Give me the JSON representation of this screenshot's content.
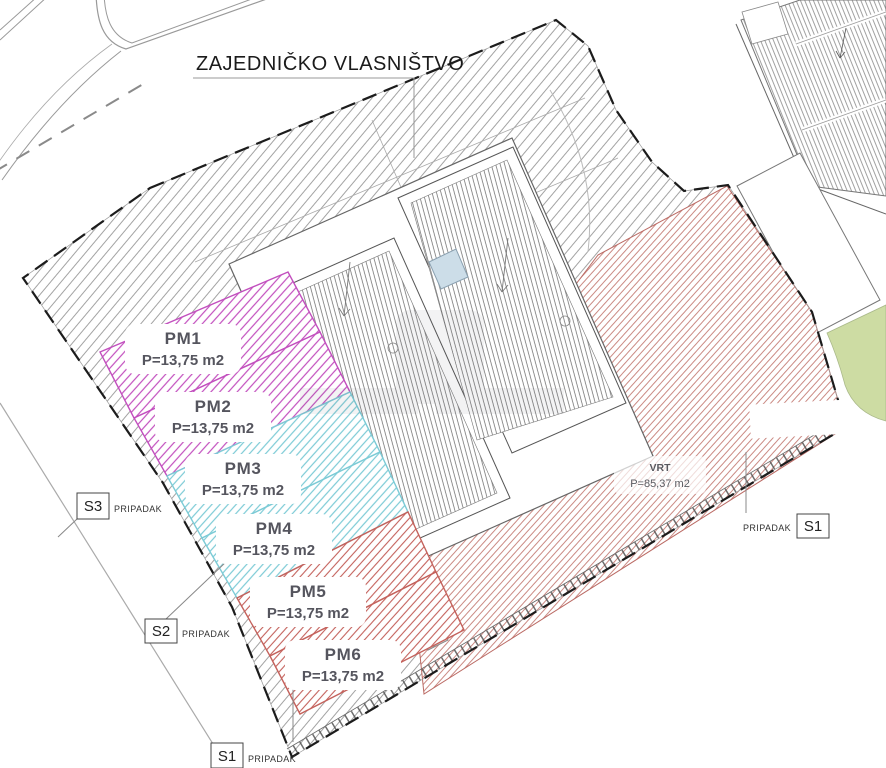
{
  "common_area_label": {
    "text": "ZAJEDNIČKO VLASNIŠTVO"
  },
  "parking_spaces": [
    {
      "id": "PM1",
      "area": "P=13,75 m2",
      "group": "magenta"
    },
    {
      "id": "PM2",
      "area": "P=13,75 m2",
      "group": "magenta"
    },
    {
      "id": "PM3",
      "area": "P=13,75 m2",
      "group": "cyan"
    },
    {
      "id": "PM4",
      "area": "P=13,75 m2",
      "group": "cyan"
    },
    {
      "id": "PM5",
      "area": "P=13,75 m2",
      "group": "red"
    },
    {
      "id": "PM6",
      "area": "P=13,75 m2",
      "group": "red"
    }
  ],
  "garden": {
    "id": "VRT",
    "area": "P=85,37 m2"
  },
  "sections": [
    {
      "id": "S3",
      "note": "PRIPADAK",
      "position": "left"
    },
    {
      "id": "S2",
      "note": "PRIPADAK",
      "position": "left-lower"
    },
    {
      "id": "S1",
      "note": "PRIPADAK",
      "position": "bottom"
    },
    {
      "id": "S1",
      "note": "PRIPADAK",
      "position": "right"
    }
  ],
  "colors": {
    "magenta_hatch": "#c24fbe",
    "cyan_hatch": "#7ccbd6",
    "red_hatch": "#c4625c",
    "garden_hatch": "#c57d76",
    "common_hatch": "#999999",
    "roof_hatch": "#666666",
    "neighbor_hatch": "#8a8a8a",
    "green_area": "#cddca3",
    "skylight": "#ccdde8"
  }
}
